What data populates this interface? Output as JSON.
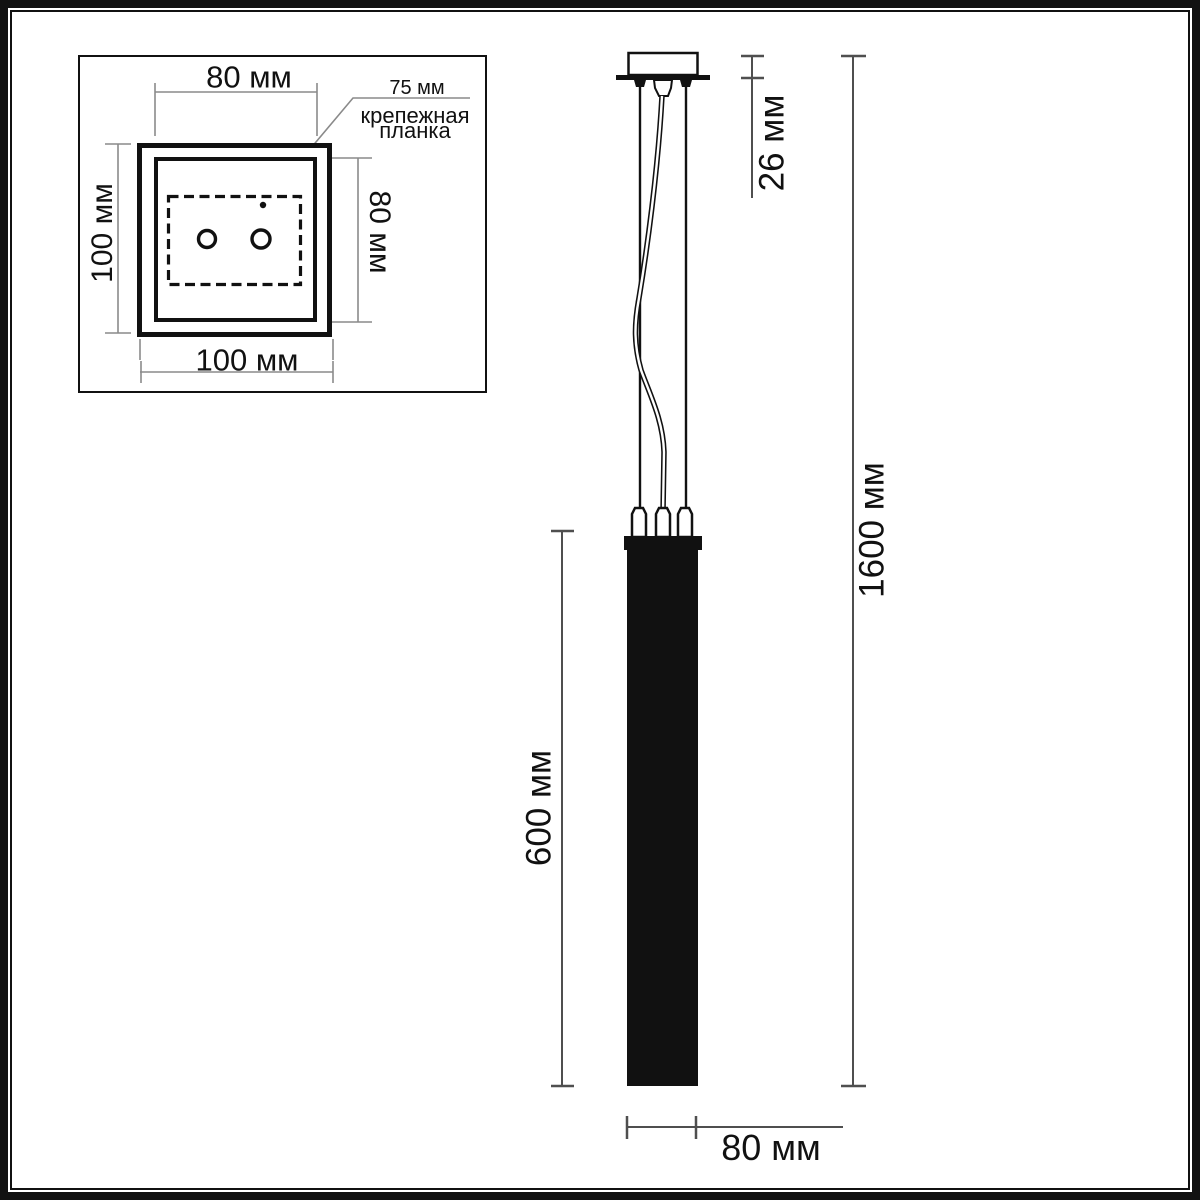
{
  "colors": {
    "ink": "#111111",
    "dim": "#4f4f4f",
    "ext": "#8a8a8a",
    "bg": "#ffffff"
  },
  "top_view": {
    "width_top": "80 мм",
    "height_left": "100 мм",
    "width_bottom": "100 мм",
    "height_right": "80 мм",
    "callout_value": "75 мм",
    "callout_line1": "крепежная",
    "callout_line2": "планка"
  },
  "side_view": {
    "canopy_height": "26 мм",
    "overall_height": "1600 мм",
    "shade_height": "600 мм",
    "shade_width": "80 мм"
  }
}
